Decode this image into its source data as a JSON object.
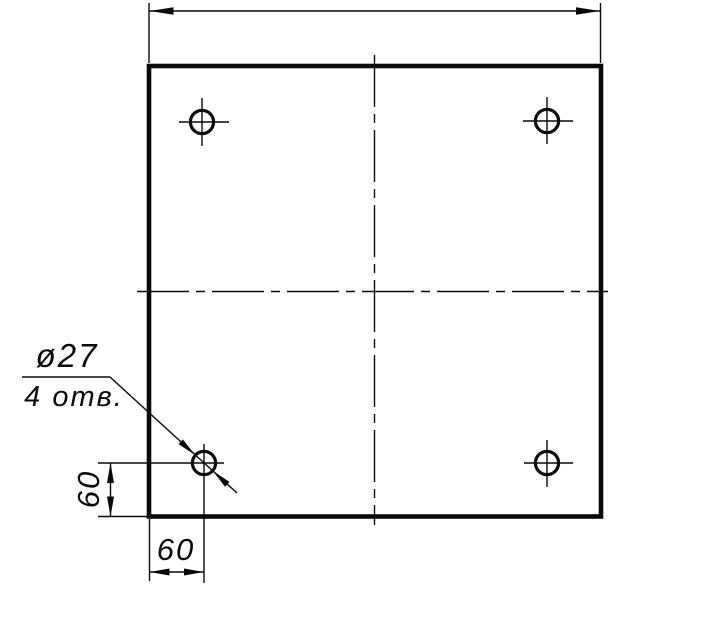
{
  "colors": {
    "paper": "#ffffff",
    "ink": "#0a0a0a"
  },
  "leader_note": {
    "line1": "ø27",
    "line2": "4 отв."
  },
  "dimensions": {
    "left_vertical_offset": "60",
    "bottom_horizontal_offset": "60"
  }
}
